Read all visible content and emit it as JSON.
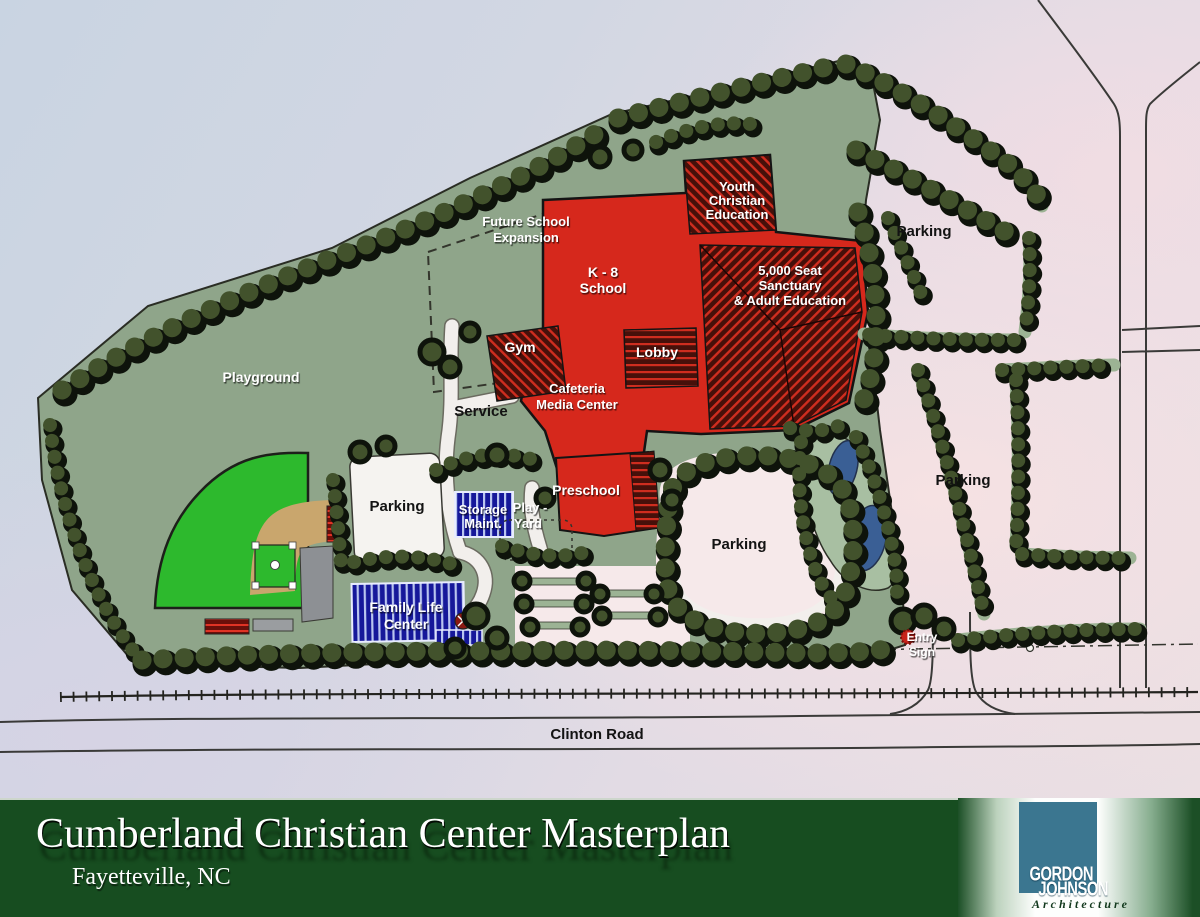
{
  "plan": {
    "labels": {
      "playground": "Playground",
      "future_school": [
        "Future School",
        "Expansion"
      ],
      "k8": [
        "K - 8",
        "School"
      ],
      "youth": [
        "Youth",
        "Christian",
        "Education"
      ],
      "sanctuary": [
        "5,000 Seat",
        "Sanctuary",
        "& Adult Education"
      ],
      "gym": "Gym",
      "lobby": "Lobby",
      "cafeteria": [
        "Cafeteria",
        "Media Center"
      ],
      "service": "Service",
      "parking": "Parking",
      "storage": [
        "Storage",
        "Maint."
      ],
      "play_yard": [
        "Play -",
        "Yard"
      ],
      "preschool": "Preschool",
      "family_life": [
        "Family Life",
        "Center"
      ],
      "entry_sign": [
        "Entry",
        "Sign"
      ],
      "clinton_road": "Clinton Road"
    },
    "colors": {
      "site_green": "#8fa58a",
      "field_green": "#2db92d",
      "infield_tan": "#c9a66d",
      "building_red": "#d6281c",
      "building_blue": "#16189a",
      "pond_blue": "#3a5f95",
      "parking_white": "#f5f3f0",
      "tree_olive": "#42522c",
      "sky_pink": "#f3e4e6",
      "sky_blue": "#ccd6e2"
    }
  },
  "title_bar": {
    "title": "Cumberland Christian Center Masterplan",
    "location": "Fayetteville, NC",
    "band_green": "#174d20"
  },
  "logo": {
    "line1": "GORDON",
    "line2": "JOHNSON",
    "line3": "Architecture",
    "teal": "#3b7690"
  }
}
